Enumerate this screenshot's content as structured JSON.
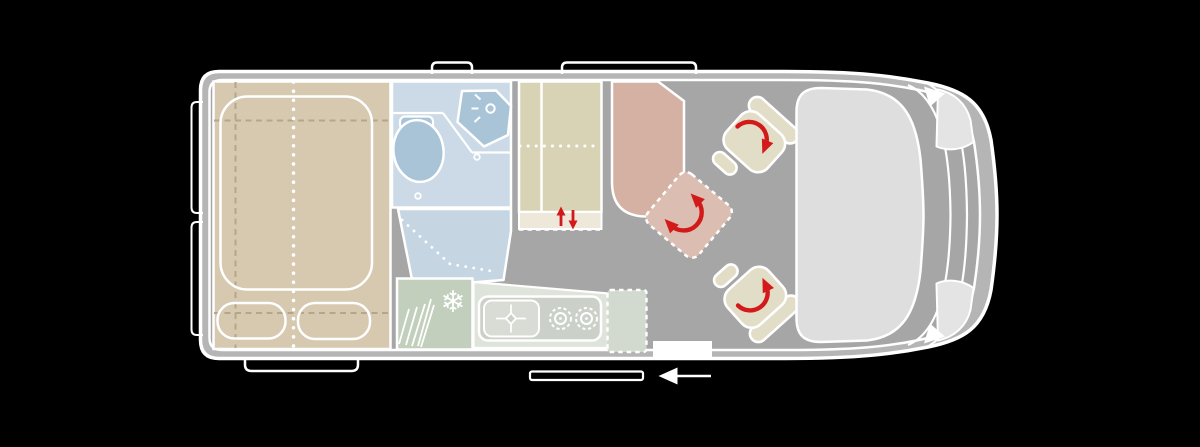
{
  "title": "campervan-floorplan",
  "colors": {
    "background": "#000000",
    "outline": "#ffffff",
    "band": "#b5b5b5",
    "floor": "#a6a6a6",
    "bed": "#d6c9b0",
    "bed_dash": "#b4a68a",
    "bath": "#cbdae6",
    "shower": "#c6d5e2",
    "fixture": "#a9c4d7",
    "wardrobe": "#d8d3b5",
    "strip": "#ede8da",
    "bench": "#d5b1a4",
    "table": "#dcbdb2",
    "seat": "#e2ddc6",
    "cab": "#dedede",
    "headlight": "#e4e4e4",
    "fridge": "#c2cfbc",
    "counter": "#dfe4da",
    "stove": "#cbd1c9",
    "sink": "#d8dcd4",
    "flap": "#d2d9ce",
    "red": "#d31a1a"
  },
  "icons": {
    "fridge_snowflake": "❄",
    "seat_rotation_arrow": "curved red arrow",
    "table_rotation_arrow": "double-headed curved red arrow",
    "wardrobe_slide_arrows": "red up/down arrows",
    "door_arrow": "white left arrow",
    "kitchen_faucet": "crosshair faucet symbol",
    "burner": "concentric-circle gas burner",
    "vent_grille": "diagonal hatch lines"
  },
  "areas": [
    {
      "id": "rear-bed",
      "label": "rear transverse bed with two cushions"
    },
    {
      "id": "bathroom",
      "label": "bathroom with toilet and corner sink"
    },
    {
      "id": "shower",
      "label": "shower floor"
    },
    {
      "id": "wardrobe",
      "label": "wardrobe with sliding element"
    },
    {
      "id": "fridge",
      "label": "refrigerator"
    },
    {
      "id": "kitchen",
      "label": "kitchen block with sink and two burners"
    },
    {
      "id": "worktop-flap",
      "label": "fold-out worktop extension"
    },
    {
      "id": "dinette-bench",
      "label": "lounge bench seat"
    },
    {
      "id": "table",
      "label": "movable table"
    },
    {
      "id": "cab-seat-rear",
      "label": "swivelling cab seat (driver side)"
    },
    {
      "id": "cab-seat-front",
      "label": "swivelling cab seat (passenger side)"
    },
    {
      "id": "cab",
      "label": "driver cab / dashboard"
    },
    {
      "id": "entry",
      "label": "entry step with sliding door"
    },
    {
      "id": "skylights",
      "label": "two roof skylights"
    },
    {
      "id": "rear-doors",
      "label": "rear door window markings"
    }
  ]
}
